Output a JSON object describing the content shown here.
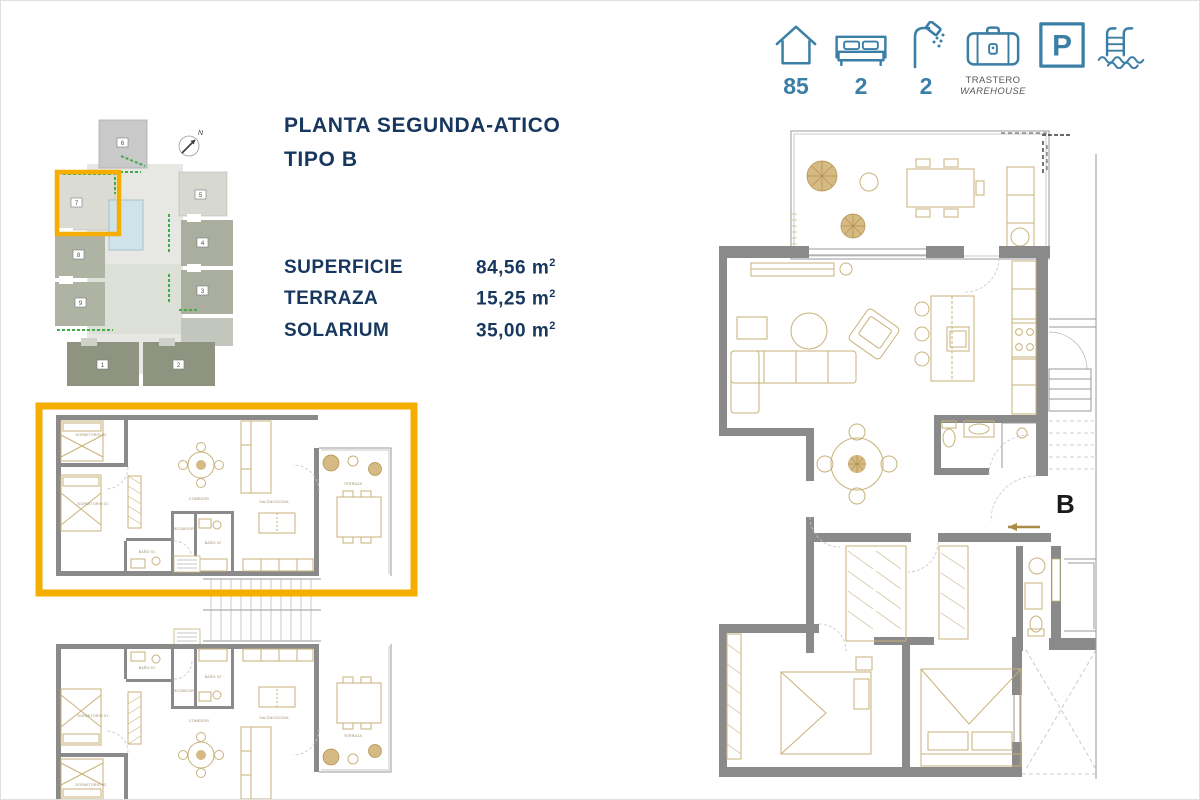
{
  "colors": {
    "accent_orange": "#F5AE00",
    "icon_blue": "#3B7FA6",
    "title_navy": "#17375F",
    "wall_grey": "#8A8A8A",
    "furniture_tan": "#C9B27A",
    "pool_blue": "#CFE3EA",
    "vegetation_green": "#3FAE49"
  },
  "icon_bar": {
    "items": [
      {
        "name": "house",
        "value": "85"
      },
      {
        "name": "bed",
        "value": "2"
      },
      {
        "name": "shower",
        "value": "2"
      },
      {
        "name": "warehouse",
        "label_line1": "TRASTERO",
        "label_line2": "WAREHOUSE"
      },
      {
        "name": "parking",
        "letter": "P"
      },
      {
        "name": "pool"
      }
    ]
  },
  "header": {
    "title_line1": "PLANTA SEGUNDA-ATICO",
    "title_line2": "TIPO B"
  },
  "specs": {
    "rows": [
      {
        "label": "SUPERFICIE",
        "value": "84,56",
        "unit": "m",
        "sup": "2"
      },
      {
        "label": "TERRAZA",
        "value": "15,25",
        "unit": "m",
        "sup": "2"
      },
      {
        "label": "SOLARIUM",
        "value": "35,00",
        "unit": "m",
        "sup": "2"
      }
    ]
  },
  "site_plan": {
    "north_label": "N",
    "highlighted_block": "7",
    "blocks": [
      "1",
      "2",
      "3",
      "4",
      "5",
      "6",
      "7",
      "8",
      "9"
    ]
  },
  "floor_plan_left": {
    "rooms": {
      "bedroom2": "DORMITORIO 02",
      "bedroom1": "DORMITORIO 01",
      "bath1": "BAÑO 01",
      "hall": "RECIBIDOR",
      "bath2": "BAÑO 02",
      "dining": "COMEDOR",
      "living": "SALÓN/COCINA",
      "terrace": "TERRAZA"
    }
  },
  "floor_plan_right": {
    "unit_label": "B"
  }
}
